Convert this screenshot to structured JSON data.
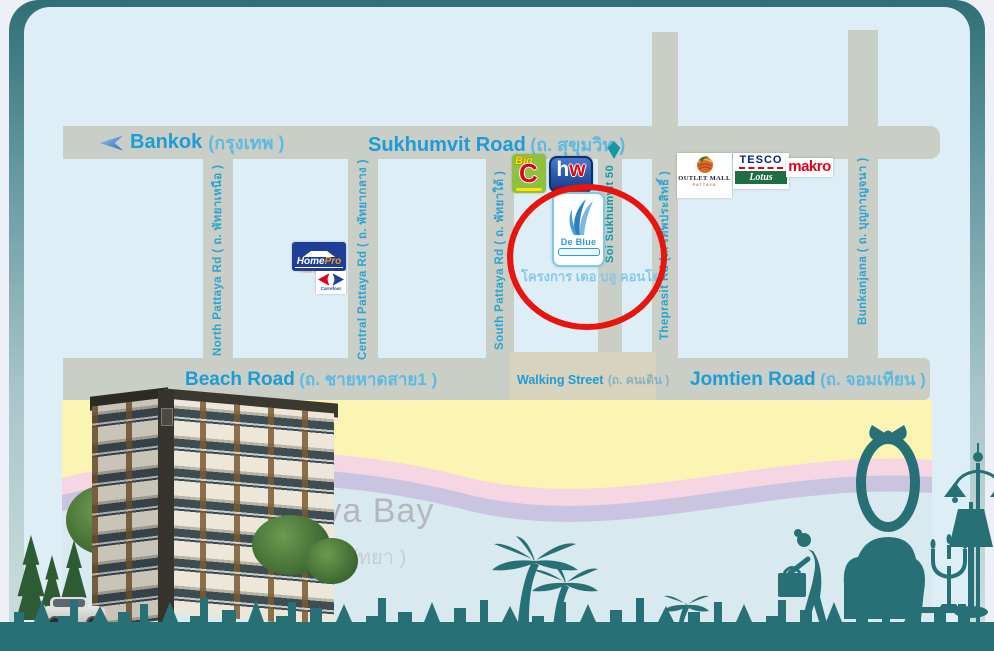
{
  "roads": {
    "bangkok": {
      "en": "Bankok",
      "th": "(กรุงเทพ )"
    },
    "sukhumvit": {
      "en": "Sukhumvit Road",
      "th": "(ถ. สุขุมวิท )"
    },
    "beach": {
      "en": "Beach Road",
      "th": "(ถ. ชายหาดสาย1 )"
    },
    "walking": {
      "en": "Walking Street",
      "th": "(ถ. คนเดิน )"
    },
    "jomtien": {
      "en": "Jomtien Road",
      "th": "(ถ. จอมเทียน )"
    },
    "north": {
      "label": "North Pattaya Rd ( ถ. พัทยาเหนือ )"
    },
    "central": {
      "label": "Central Pattaya Rd ( ถ. พัทยากลาง )"
    },
    "south": {
      "label": "South Pattaya Rd ( ถ. พัทยาใต้ )"
    },
    "soi50": {
      "label": "Soi Sukhumvit 50"
    },
    "theprasit": {
      "label": "Theprasit Rd (ถ. เทพประสิทธิ์ )"
    },
    "bunkanjana": {
      "label": "Bunkanjana ( ถ. บุญกาญจนา )"
    }
  },
  "landmarks": {
    "homepro": {
      "home": "Home",
      "pro": "Pro",
      "tagline": "Home is HomePro"
    },
    "carrefour": {
      "label": "Carrefour"
    },
    "bigc": {
      "big": "Big",
      "c": "C"
    },
    "homeworks": {
      "h": "h",
      "w": "w"
    },
    "deblue": {
      "name": "De Blue",
      "thai_caption": "โครงการ เดอ บลู คอนโด"
    },
    "outlet_mall": {
      "line1": "OUTLET MALL",
      "line2": "PATTAYA"
    },
    "tesco_lotus": {
      "tesco": "TESCO",
      "lotus": "Lotus"
    },
    "makro": {
      "label": "makro"
    }
  },
  "bay": {
    "en": "Pattaya Bay",
    "th": "( อ่าวพัทยา )"
  },
  "colors": {
    "panel": "#ddeef6",
    "road": "#c9cec6",
    "walking_band": "#d8d3be",
    "label_blue": "#1e9cd6",
    "label_blue_light": "#5fb9e0",
    "soi_teal": "#0f98a6",
    "beach_yellow": "#fbf4b2",
    "wave_pink": "#f7d6e3",
    "wave_lavender": "#c9c4e0",
    "sea": "#d8e9ef",
    "silhouette_teal": "#277176",
    "highlight_red": "#e8140e"
  }
}
